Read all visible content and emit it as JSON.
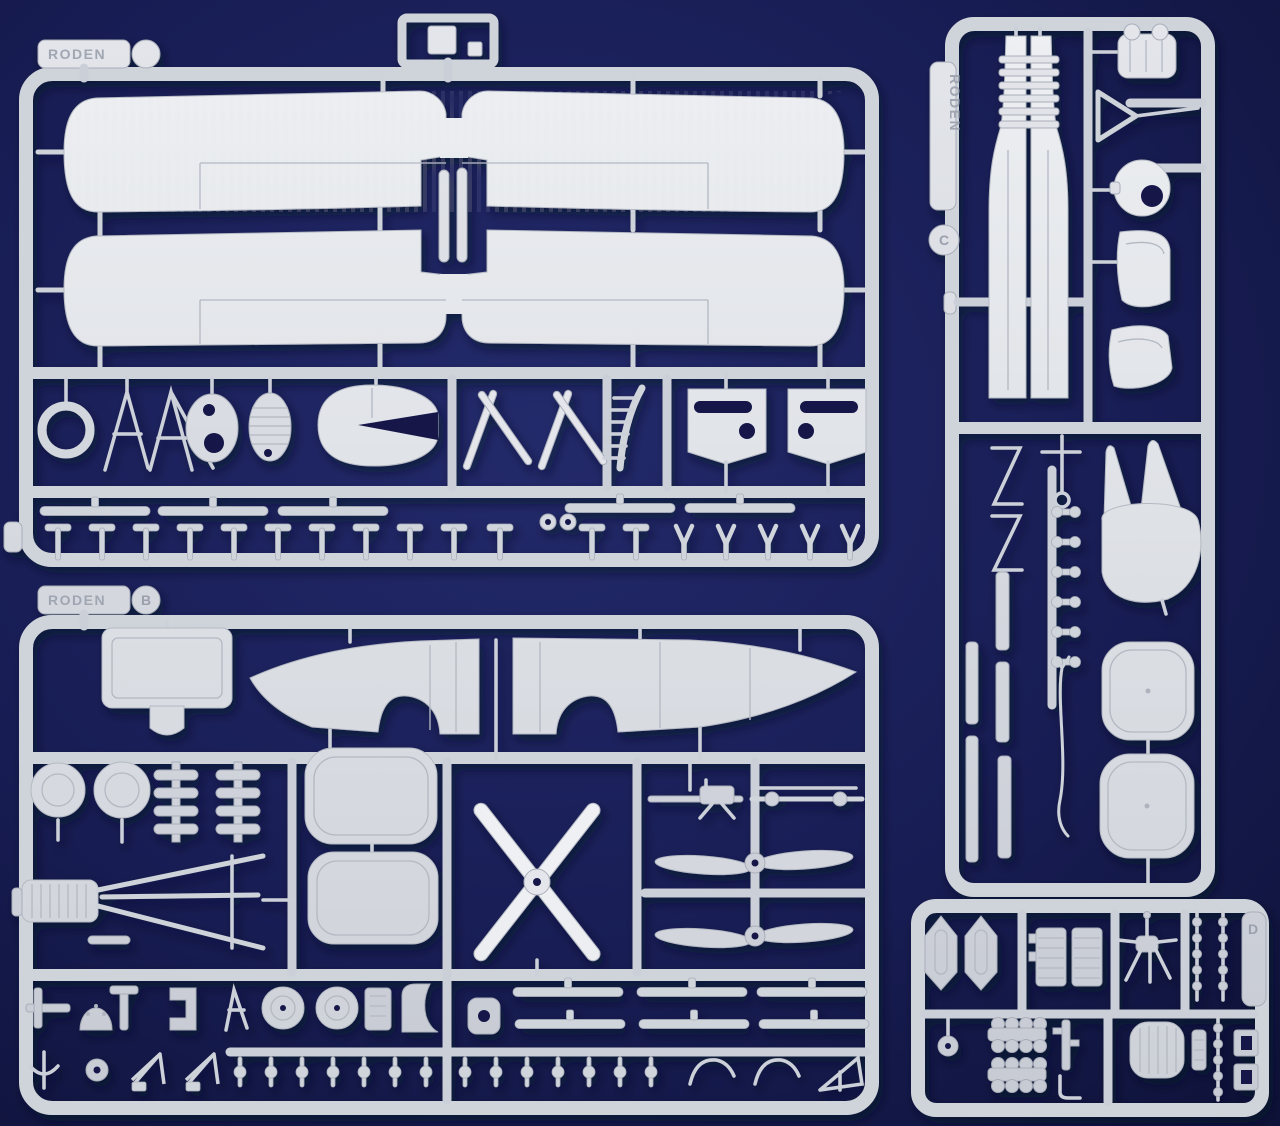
{
  "scene": {
    "type": "photograph",
    "subject": "Four light-grey injection-molded polystyrene sprues (runners) of a WWI biplane model aircraft kit on a dark navy background",
    "background_color": "#181d55",
    "plastic_color": "#d3d6dc",
    "plastic_highlight": "#eef0f3",
    "plastic_shadow": "#a6abb6",
    "brand": "RODEN"
  },
  "sprues": [
    {
      "id": "A",
      "position": "top-left",
      "tag_text": "RODEN",
      "tag_letter": "",
      "parts": [
        "upper-wing-halves",
        "lower-wing-halves",
        "center-section-struts",
        "cowling-ring",
        "cabane-strut-tripods",
        "firewall-bulkhead",
        "radiator-core",
        "engine-cowling",
        "v-interplane-struts",
        "exhaust-manifold",
        "cowling-side-panels",
        "strut-airfoil-strips",
        "small-t-fittings",
        "fork-fittings"
      ]
    },
    {
      "id": "B",
      "position": "bottom-left",
      "tag_text": "RODEN",
      "tag_letter": "B",
      "parts": [
        "fuselage-halves",
        "seat-back-panel",
        "wheels",
        "engine-cylinder-banks",
        "fuel-tank-panels",
        "four-blade-propeller",
        "two-blade-propellers",
        "machine-gun",
        "wheel-axle",
        "inline-engine-block",
        "landing-gear-legs",
        "strut-airfoil-strips",
        "rigging-beads",
        "wheel-discs",
        "bracket-fittings",
        "wire-hooks"
      ]
    },
    {
      "id": "C",
      "position": "right",
      "tag_text": "RODEN",
      "tag_letter": "C",
      "parts": [
        "fuselage-halves-with-louvers",
        "engine-block",
        "venturi-funnel",
        "pulley-disc",
        "wingtip-panels",
        "zigzag-struts",
        "aerial-mast",
        "control-horn-ladder",
        "fin-halves",
        "rudder",
        "tailplane-halves",
        "cockpit-frame-strips",
        "control-wire"
      ]
    },
    {
      "id": "D",
      "position": "bottom-right",
      "tag_text": "",
      "tag_letter": "D",
      "parts": [
        "radiator-shells",
        "ribbed-radiator-cores",
        "engine-bearer-spider",
        "beaded-axle-rods",
        "ball-float",
        "cylinder-bank-combs",
        "valve-gear",
        "ribbed-fuel-tank",
        "control-rod-beads",
        "mounting-brackets"
      ]
    }
  ]
}
